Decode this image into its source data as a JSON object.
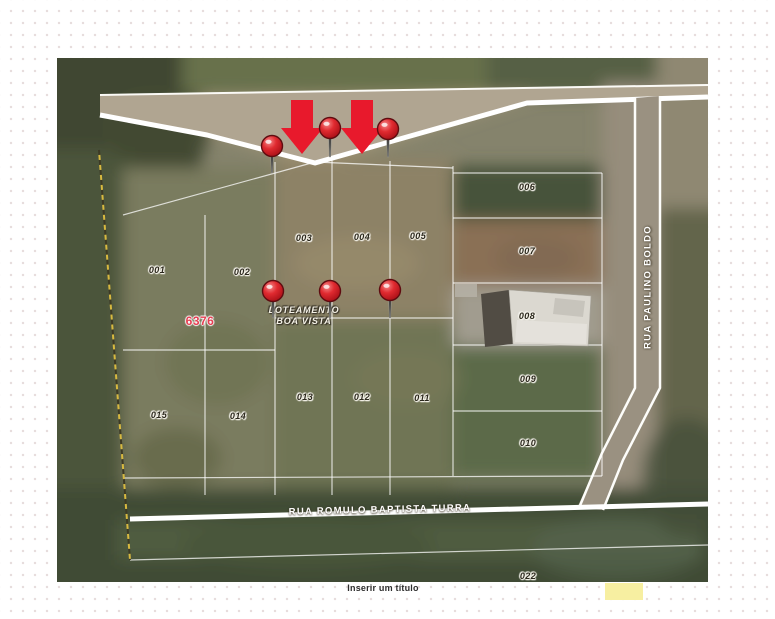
{
  "canvas": {
    "title_placeholder": "Inserir um título"
  },
  "map": {
    "subdivision": {
      "line1": "LOTEAMENTO",
      "line2": "BOA VISTA"
    },
    "block_number": "6376",
    "streets": {
      "bottom": "RUA ROMULO BAPTISTA TURRA",
      "right": "RUA PAULINO BOLDO"
    },
    "parcels": [
      {
        "id": "001"
      },
      {
        "id": "002"
      },
      {
        "id": "003"
      },
      {
        "id": "004"
      },
      {
        "id": "005"
      },
      {
        "id": "006"
      },
      {
        "id": "007"
      },
      {
        "id": "008"
      },
      {
        "id": "009"
      },
      {
        "id": "010"
      },
      {
        "id": "011"
      },
      {
        "id": "012"
      },
      {
        "id": "013"
      },
      {
        "id": "014"
      },
      {
        "id": "015"
      },
      {
        "id": "022"
      }
    ],
    "markers": {
      "pin_count": 6,
      "arrow_count": 2,
      "pin_color": "#d6202c",
      "arrow_color": "#e8192c"
    },
    "highlight_color": "#f7efa1",
    "road_color": "#ffffff"
  }
}
